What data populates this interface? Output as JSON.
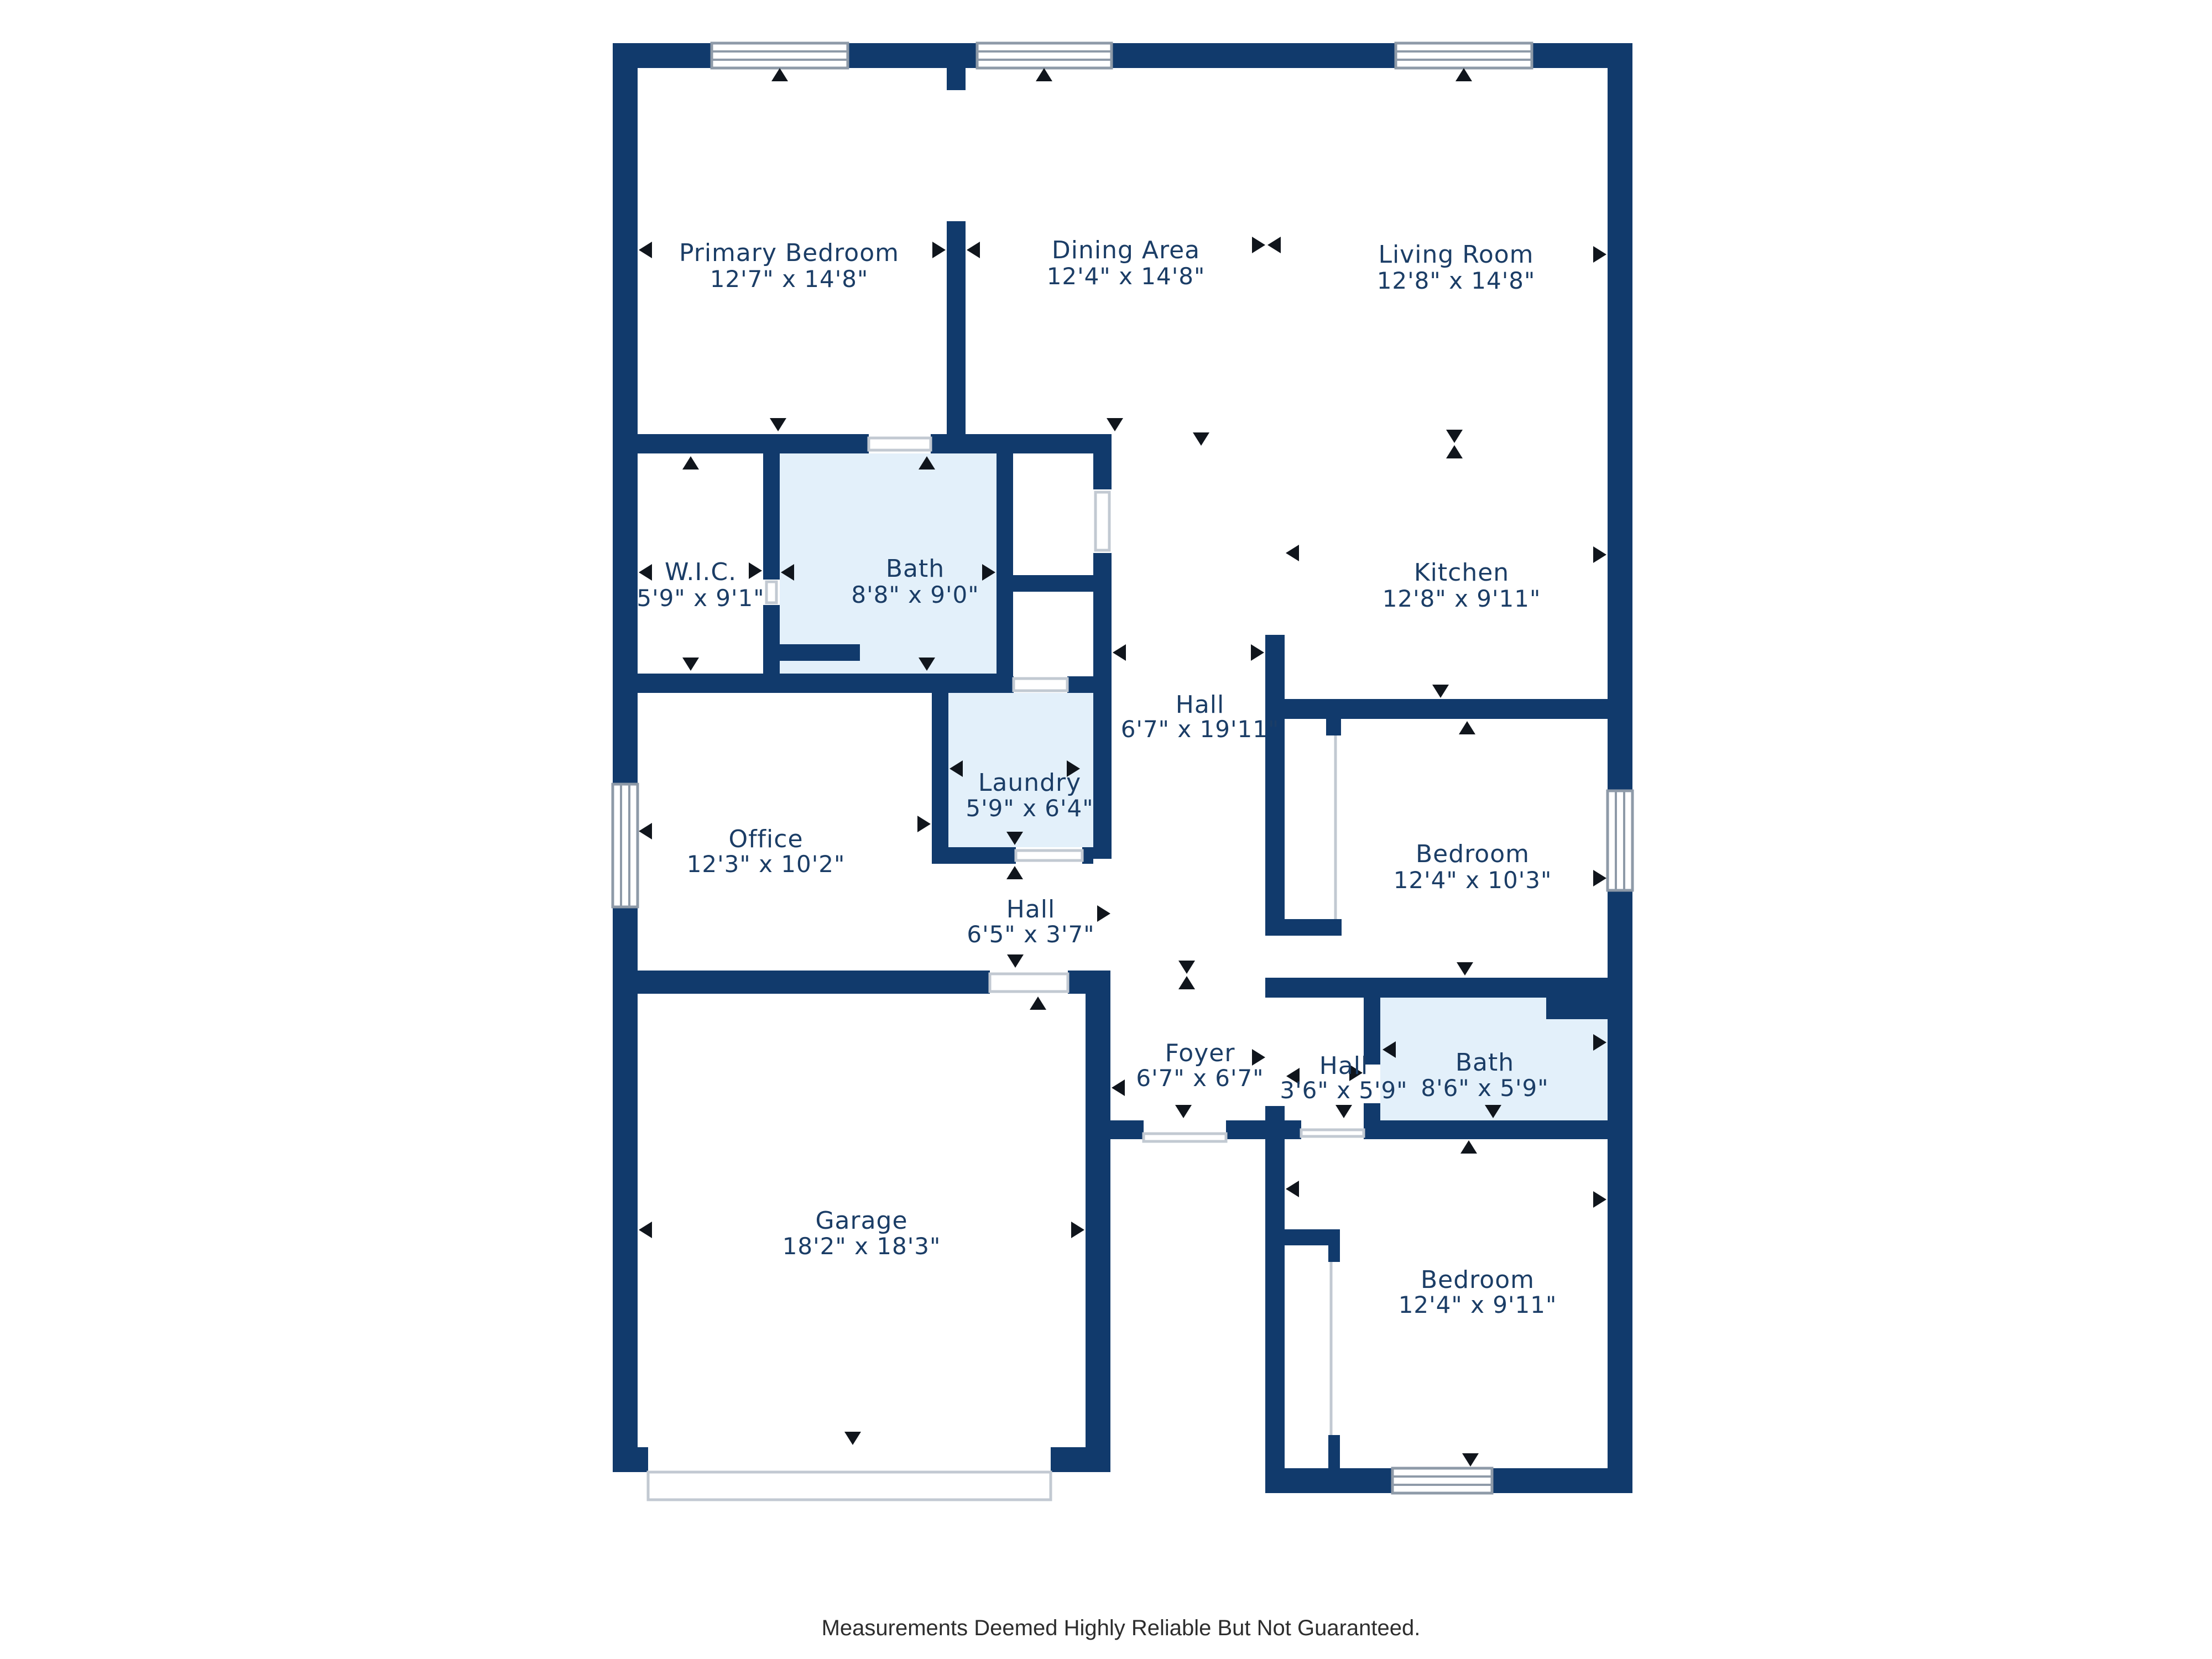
{
  "floor_plan": {
    "rooms": {
      "primary_bedroom": {
        "name": "Primary Bedroom",
        "dims": "12'7\" x 14'8\""
      },
      "dining_area": {
        "name": "Dining Area",
        "dims": "12'4\" x 14'8\""
      },
      "living_room": {
        "name": "Living Room",
        "dims": "12'8\" x 14'8\""
      },
      "wic": {
        "name": "W.I.C.",
        "dims": "5'9\" x 9'1\""
      },
      "bath_primary": {
        "name": "Bath",
        "dims": "8'8\" x 9'0\""
      },
      "kitchen": {
        "name": "Kitchen",
        "dims": "12'8\" x 9'11\""
      },
      "hall_main": {
        "name": "Hall",
        "dims": "6'7\" x 19'11\""
      },
      "laundry": {
        "name": "Laundry",
        "dims": "5'9\" x 6'4\""
      },
      "office": {
        "name": "Office",
        "dims": "12'3\" x 10'2\""
      },
      "bedroom_mid": {
        "name": "Bedroom",
        "dims": "12'4\" x 10'3\""
      },
      "hall_small": {
        "name": "Hall",
        "dims": "6'5\" x 3'7\""
      },
      "foyer": {
        "name": "Foyer",
        "dims": "6'7\" x 6'7\""
      },
      "hall_rear": {
        "name": "Hall",
        "dims": "3'6\" x 5'9\""
      },
      "bath_rear": {
        "name": "Bath",
        "dims": "8'6\" x 5'9\""
      },
      "garage": {
        "name": "Garage",
        "dims": "18'2\" x 18'3\""
      },
      "bedroom_bottom": {
        "name": "Bedroom",
        "dims": "12'4\" x 9'11\""
      }
    },
    "footer": {
      "disclaimer": "Measurements Deemed Highly Reliable But Not Guaranteed."
    },
    "colors": {
      "wall": "#113a6c",
      "highlight": "#e3f0fa",
      "label": "#1b3d66",
      "marker": "#10151c",
      "door_line": "#c2c9d2",
      "window_frame": "#8e9aa8",
      "footer_text": "#2d2d2d",
      "background": "#ffffff"
    }
  }
}
